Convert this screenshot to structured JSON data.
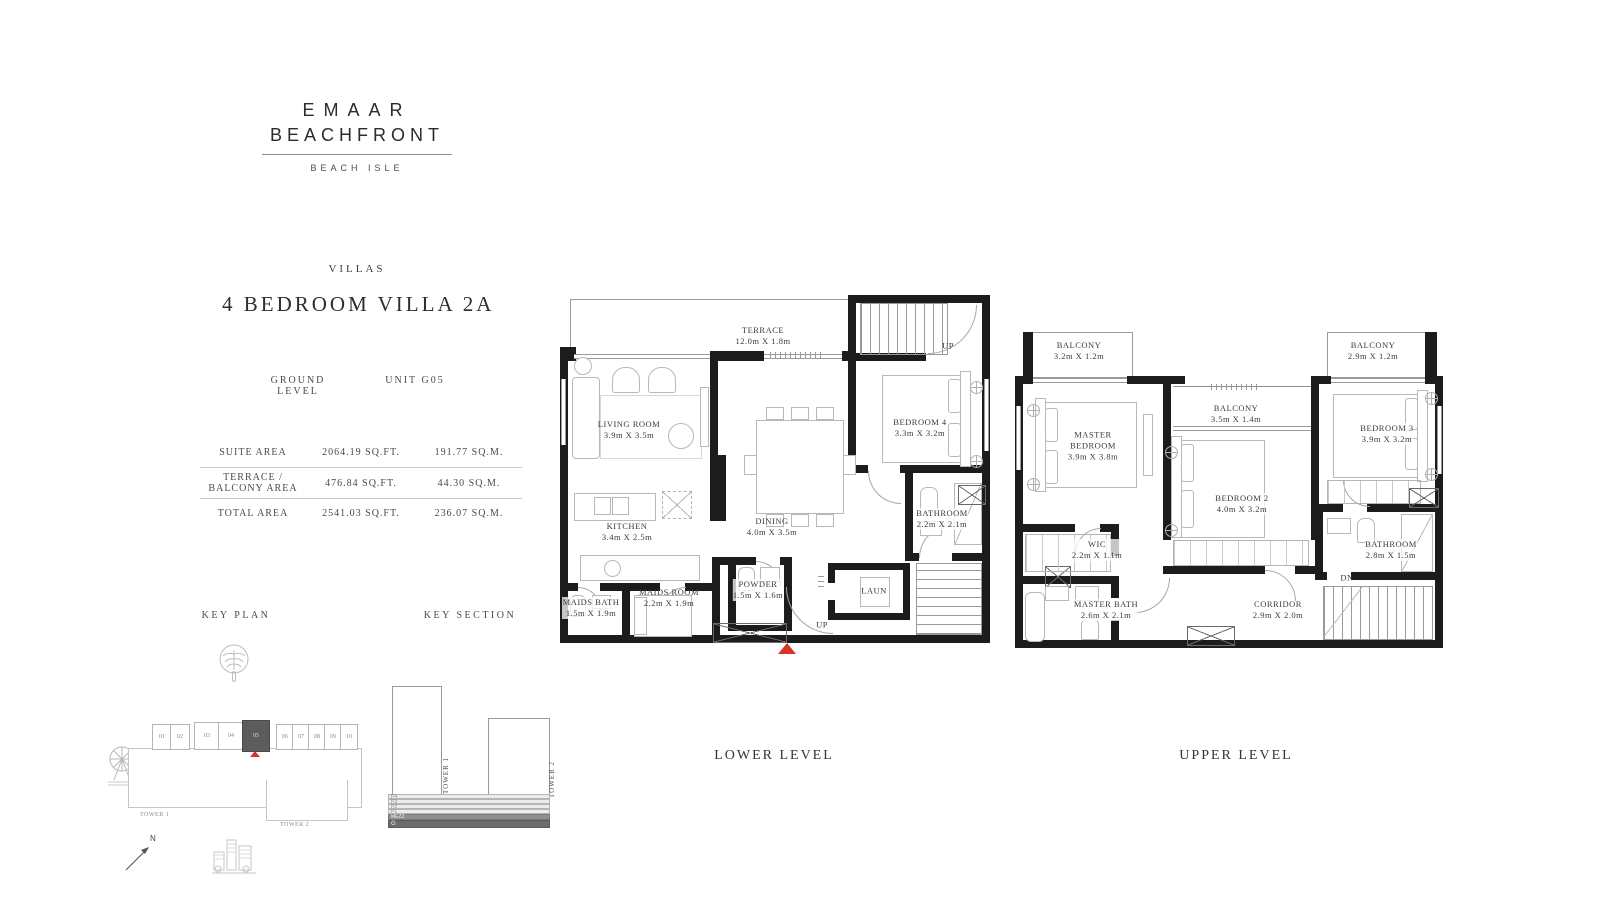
{
  "brand": {
    "line1": "EMAAR",
    "line2": "BEACHFRONT",
    "sub": "BEACH ISLE"
  },
  "header": {
    "category": "VILLAS",
    "title": "4 BEDROOM VILLA 2A",
    "level": "GROUND LEVEL",
    "unit": "UNIT G05"
  },
  "areas": {
    "rows": [
      {
        "label": "SUITE AREA",
        "sqft": "2064.19 SQ.FT.",
        "sqm": "191.77 SQ.M."
      },
      {
        "label": "TERRACE / BALCONY AREA",
        "sqft": "476.84 SQ.FT.",
        "sqm": "44.30 SQ.M."
      },
      {
        "label": "TOTAL AREA",
        "sqft": "2541.03 SQ.FT.",
        "sqm": "236.07 SQ.M."
      }
    ]
  },
  "key_plan": {
    "label": "KEY PLAN",
    "units": [
      "01",
      "02",
      "03",
      "04",
      "05",
      "06",
      "07",
      "08",
      "09",
      "10"
    ],
    "highlighted_unit": "05",
    "tower1": "TOWER 1",
    "tower2": "TOWER 2"
  },
  "key_section": {
    "label": "KEY SECTION",
    "tower1": "TOWER 1",
    "tower2": "TOWER 2",
    "levels": [
      "P4",
      "P3",
      "P2",
      "P1",
      "MEZZ",
      "G"
    ]
  },
  "compass": {
    "north": "N"
  },
  "icons": [
    "palm-island-icon",
    "ferris-wheel-icon",
    "marina-skyline-icon",
    "north-arrow-icon"
  ],
  "lower": {
    "caption": "LOWER LEVEL",
    "up": "UP",
    "rooms": [
      {
        "name": "TERRACE",
        "dims": "12.0m X 1.8m"
      },
      {
        "name": "LIVING ROOM",
        "dims": "3.9m X 3.5m"
      },
      {
        "name": "BEDROOM 4",
        "dims": "3.3m X 3.2m"
      },
      {
        "name": "KITCHEN",
        "dims": "3.4m X 2.5m"
      },
      {
        "name": "DINING",
        "dims": "4.0m X 3.5m"
      },
      {
        "name": "BATHROOM",
        "dims": "2.2m X 2.1m"
      },
      {
        "name": "MAIDS BATH",
        "dims": "1.5m X 1.9m"
      },
      {
        "name": "MAIDS ROOM",
        "dims": "2.2m X 1.9m"
      },
      {
        "name": "POWDER",
        "dims": "1.5m X 1.6m"
      },
      {
        "name": "LAUN",
        "dims": ""
      }
    ]
  },
  "upper": {
    "caption": "UPPER LEVEL",
    "dn": "DN",
    "rooms": [
      {
        "name": "BALCONY",
        "dims": "3.2m X 1.2m"
      },
      {
        "name": "BALCONY",
        "dims": "3.5m X 1.4m"
      },
      {
        "name": "BALCONY",
        "dims": "2.9m X 1.2m"
      },
      {
        "name": "MASTER BEDROOM",
        "dims": "3.9m X 3.8m"
      },
      {
        "name": "BEDROOM 2",
        "dims": "4.0m X 3.2m"
      },
      {
        "name": "BEDROOM 3",
        "dims": "3.9m X 3.2m"
      },
      {
        "name": "WIC",
        "dims": "2.2m X 1.1m"
      },
      {
        "name": "MASTER BATH",
        "dims": "2.6m X 2.1m"
      },
      {
        "name": "BATHROOM",
        "dims": "2.8m X 1.5m"
      },
      {
        "name": "CORRIDOR",
        "dims": "2.9m X 2.0m"
      }
    ]
  },
  "colors": {
    "wall": "#1c1c1c",
    "accent_red": "#d8342c",
    "line_gray": "#9a9a9a"
  }
}
